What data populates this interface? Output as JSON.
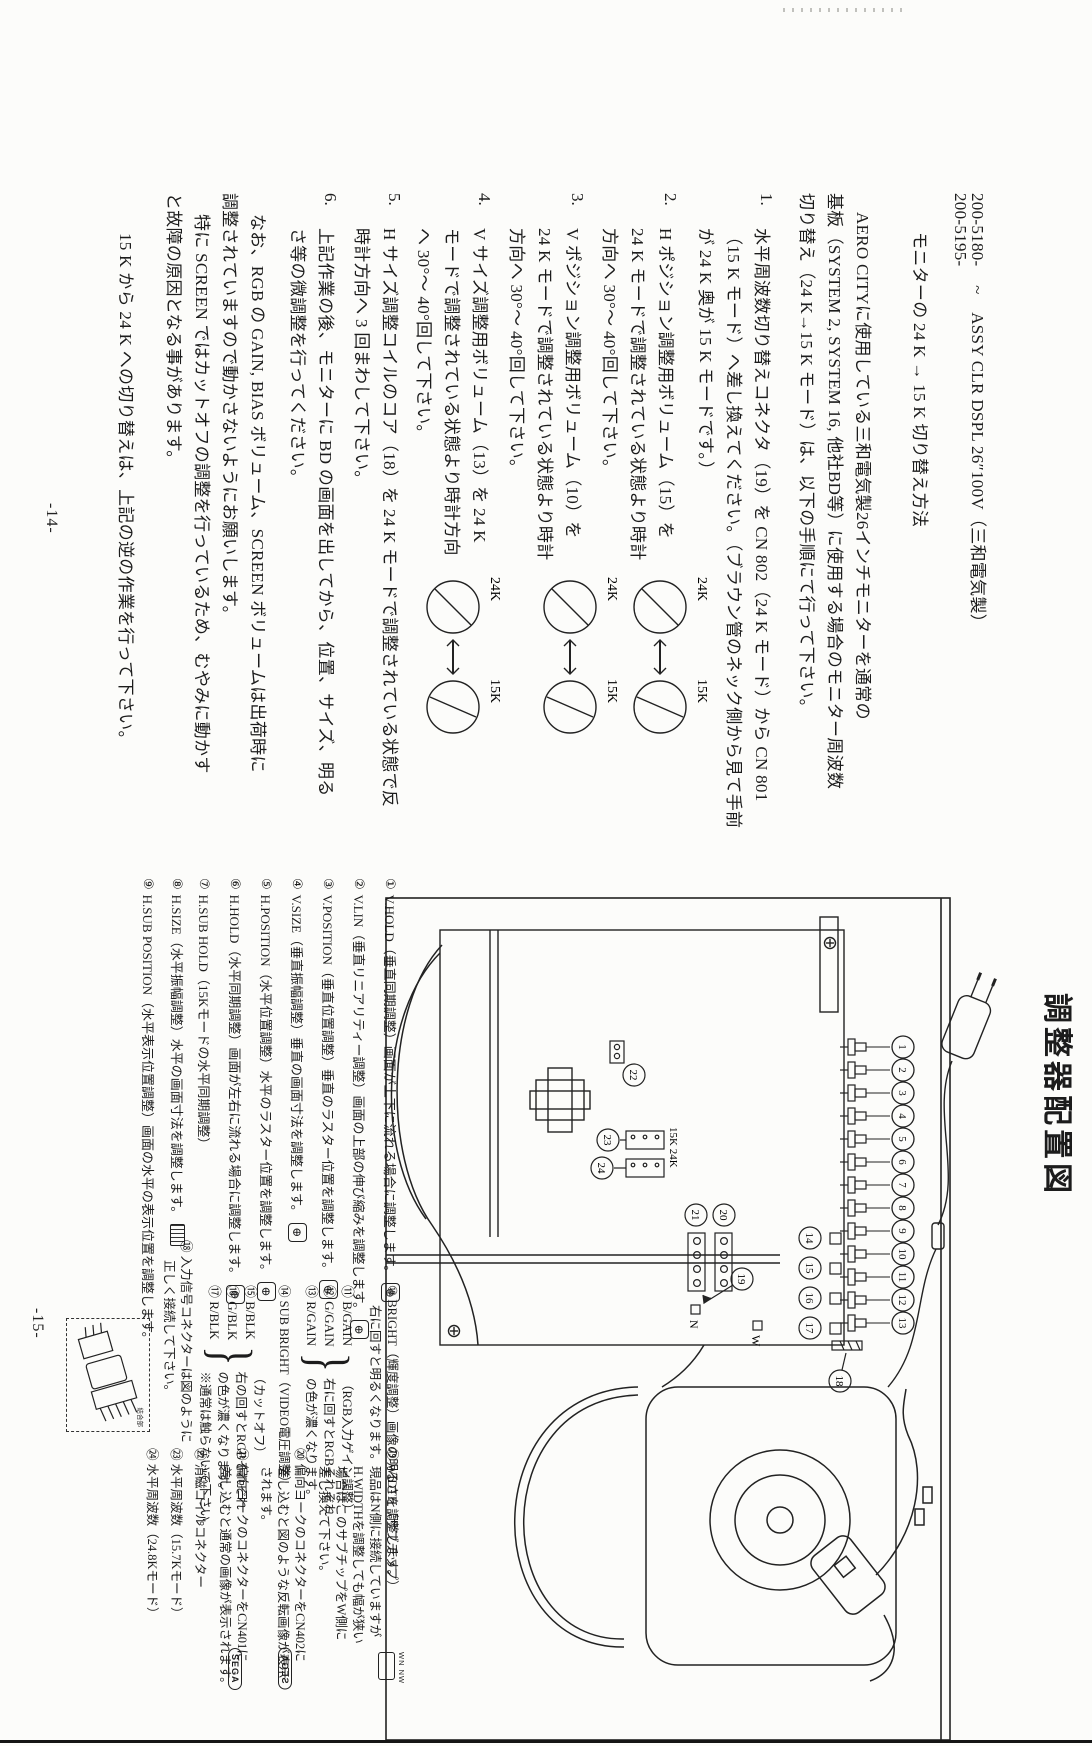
{
  "page14": {
    "page_number": "-14-",
    "part_number_1": "200-5180-",
    "part_number_2": "200-5195-",
    "tilde": "~",
    "header_title": "ASSY CLR DSPL 26″100V（三和電気製）",
    "subtitle": "モニターの 24 K → 15 K 切り替え方法",
    "intro_lines": [
      "AERO CITYに使用している三和電気製26インチモニターを通常の",
      "基板（SYSTEM 2, SYSTEM 16, 他社BD等）に使用する場合のモニター周波数",
      "切り替え（24 K→15 K モード）は、以下の手順にて行って下さい。"
    ],
    "steps": [
      {
        "num": "1.",
        "lines": [
          "水平周波数切り替えコネクタ（19）を CN 802（24 K モード）から CN 801",
          "（15 K モード）へ差し換えてください。（ブラウン管のネック側から見て手前",
          "が 24 K 奥が 15 K モードです。）"
        ]
      },
      {
        "num": "2.",
        "lines": [
          "H ポジション調整用ボリューム（15）を",
          "24 K モードで調整されている状態より時計",
          "方向へ 30°〜 40°回して下さい。"
        ]
      },
      {
        "num": "3.",
        "lines": [
          "V ポジション調整用ボリューム（10）を",
          "24 K モードで調整されている状態より時計",
          "方向へ 30°〜 40°回して下さい。"
        ]
      },
      {
        "num": "4.",
        "lines": [
          "V サイズ調整用ボリューム（13）を 24 K",
          "モードで調整されている状態より時計方向",
          "へ 30°〜 40°回して下さい。"
        ]
      },
      {
        "num": "5.",
        "lines": [
          "H サイズ調整コイルのコア（18）を 24 K モードで調整されている状態で反",
          "時計方向へ 3 回まわして下さい。"
        ]
      },
      {
        "num": "6.",
        "lines": [
          "上記作業の後、モニターに BD の画面を出してから、位置、サイズ、明る",
          "さ等の微調整を行ってください。"
        ]
      }
    ],
    "knob_figures": [
      {
        "left": "24K",
        "right": "15K"
      },
      {
        "left": "24K",
        "right": "15K"
      },
      {
        "left": "24K",
        "right": "15K"
      }
    ],
    "note_lines": [
      "なお、RGB の GAIN, BIAS ボリューム、SCREEN ボリュームは出荷時に",
      "調整されていますので動かさないようにお願いします。",
      "特に SCREEN ではカットオフの調整を行っているため、むやみに動かす",
      "と故障の原因となる事があります。"
    ],
    "closing_line": "15 K から 24 K への切り替えは、上記の逆の作業を行って下さい。"
  },
  "page15": {
    "page_number": "-15-",
    "title": "調整器配置図",
    "diagram": {
      "callouts_row1": [
        "1",
        "2",
        "3",
        "4",
        "5",
        "6",
        "7",
        "8",
        "9",
        "10",
        "11",
        "12",
        "13"
      ],
      "callouts_row2": [
        "14",
        "15",
        "16",
        "17"
      ],
      "callout_18": "18",
      "callout_19": "19",
      "callout_20": "20",
      "callout_21": "21",
      "callout_22": "22",
      "callout_23": "23",
      "callout_24": "24",
      "label_n": "N",
      "label_w": "W",
      "freq_labels": "15K 24K"
    },
    "annotations_left": [
      {
        "num": "①",
        "text": "V.HOLD（垂直同期調整）画面が上下に流れる場合に調整します。"
      },
      {
        "num": "②",
        "text": "V.LIN（垂直リニアリティー調整）画面の上部の伸び縮みを調整します。"
      },
      {
        "num": "③",
        "text": "V.POSITION（垂直位置調整）垂直のラスター位置を調整します。"
      },
      {
        "num": "④",
        "text": "V.SIZE（垂直振幅調整）垂直の画面寸法を調整します。"
      },
      {
        "num": "⑤",
        "text": "H.POSITION（水平位置調整）水平のラスター位置を調整します。"
      },
      {
        "num": "⑥",
        "text": "H.HOLD（水平同期調整）画面が左右に流れる場合に調整します。"
      },
      {
        "num": "⑦",
        "text": "H.SUB HOLD（15Kモードの水平同期調整）"
      },
      {
        "num": "⑧",
        "text": "H.SIZE（水平振幅調整）水平の画面寸法を調整します。"
      },
      {
        "num": "⑨",
        "text": "H.SUB POSITION（水平表示位置調整）画面の水平の表示位置を調整します。"
      }
    ],
    "annotation_10": {
      "num": "⑩",
      "lines": [
        "BRIGHT（輝度調整）画像の明るさを調整します。",
        "右に回すと明るくなります。"
      ]
    },
    "group_gain": {
      "labels": [
        "⑪ B/GAIN",
        "⑫ G/GAIN",
        "⑬ R/GAIN"
      ],
      "brace": "}",
      "desc_lines": [
        "（RGB入力ゲイン調整）",
        "右に回すとRGBそれぞれ",
        "の色が濃くなります。"
      ]
    },
    "annotation_14": {
      "num": "⑭",
      "text": "SUB BRIGHT（VIDEO電圧調整）"
    },
    "group_blk": {
      "labels": [
        "⑮ B/BLK",
        "⑯ G/BLK",
        "⑰ R/BLK"
      ],
      "brace": "}",
      "desc_lines": [
        "（カットオフ）",
        "右の回すとRGBそれぞれ",
        "の色が濃くなります。",
        "※通常は触らないで下さい。"
      ]
    },
    "annotation_18": {
      "num": "⑱",
      "lines": [
        "入力信号コネクターは図のように",
        "正しく接続して下さい。"
      ]
    },
    "connector_box_label": "結合部",
    "annotation_19": {
      "num": "⑲",
      "lines": [
        "WIDTH（サブチップ）",
        "現品はN側に接続していますが",
        "H.WIDTHを調整しても幅が狭い",
        "場合はこのサブチップをW側に",
        "差し換えて下さい。"
      ],
      "icon_label": "WN NW"
    },
    "annotation_20": {
      "num": "⑳",
      "lines": [
        "偏向ヨークのコネクターをCN402に",
        "差し込むと図のような反転画像が表示",
        "されます。"
      ],
      "icon": "SEGA"
    },
    "annotation_21": {
      "num": "㉑",
      "lines": [
        "偏向ヨークのコネクターをCN401に",
        "差し込むと通常の画像が表示されます。"
      ],
      "icon": "SEGA"
    },
    "annotation_22": {
      "num": "㉒",
      "text": "消磁コイルコネクター"
    },
    "annotation_23": {
      "num": "㉓",
      "text": "水平周波数（15.7Kモード）"
    },
    "annotation_24": {
      "num": "㉔",
      "text": "水平周波数（24.8Kモード）"
    }
  }
}
